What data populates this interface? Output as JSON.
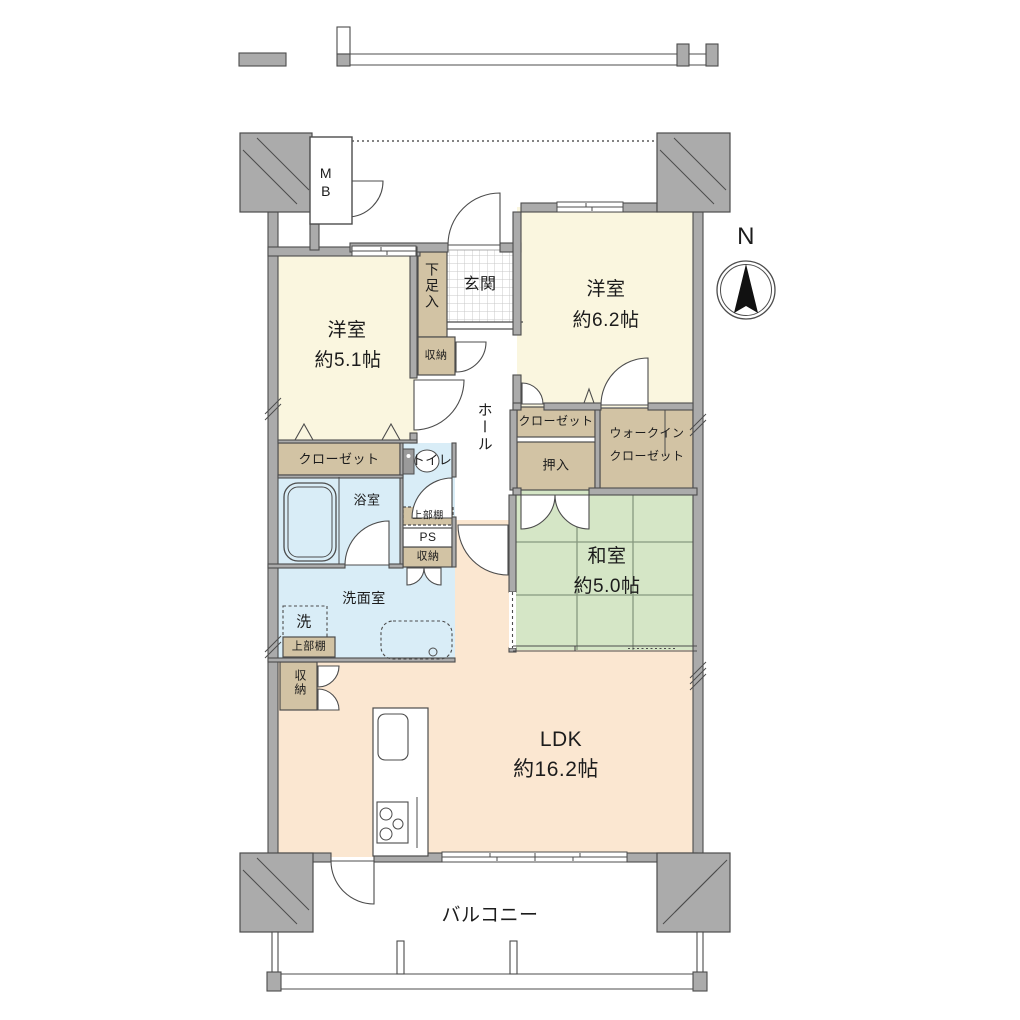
{
  "title": "マンション間取り図",
  "palette": {
    "room_cream": "#FAF6DF",
    "tatami_green": "#D5E6C6",
    "ldk_peach": "#FBE7D1",
    "water_blue": "#D9EDF7",
    "storage_tan": "#D2C3A4",
    "wall_gray": "#ABABAB",
    "outline": "#4C4C4C"
  },
  "rooms": {
    "bedroom1": {
      "name": "洋室",
      "size": "約5.1帖"
    },
    "bedroom2": {
      "name": "洋室",
      "size": "約6.2帖"
    },
    "japanese_room": {
      "name": "和室",
      "size": "約5.0帖"
    },
    "ldk": {
      "name": "LDK",
      "size": "約16.2帖"
    },
    "balcony": {
      "name": "バルコニー"
    },
    "entrance": {
      "name": "玄関"
    },
    "hall": {
      "name": "ホール"
    },
    "bathroom": {
      "name": "浴室"
    },
    "washroom": {
      "name": "洗面室"
    },
    "toilet": {
      "name": "トイレ"
    }
  },
  "storage": {
    "shoe_cabinet": "下足入",
    "hall_storage": "収納",
    "closet1": "クローゼット",
    "closet2": "クローゼット",
    "oshiire": "押入",
    "wic_line1": "ウォークイン",
    "wic_line2": "クローゼット",
    "upper_shelf_toilet": "上部棚",
    "pipe_space": "PS",
    "mid_storage": "収納",
    "washer": "洗",
    "upper_shelf_wash": "上部棚",
    "ldk_storage": "収納",
    "meter_box_line1": "M",
    "meter_box_line2": "B"
  },
  "compass": {
    "north": "N"
  }
}
